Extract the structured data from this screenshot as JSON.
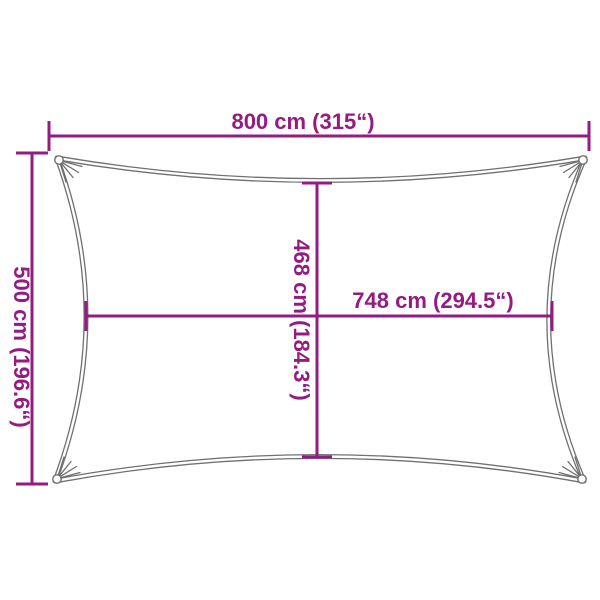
{
  "diagram": {
    "type": "shade-sail-dimension-diagram",
    "colors": {
      "dimension": "#941b80",
      "sail": "#707070",
      "gap": "#ffffff"
    },
    "labels": {
      "width": "800 cm (315“)",
      "height": "500 cm (196.6“)",
      "inner_width": "748 cm (294.5“)",
      "inner_height": "468 cm (184.3“)"
    }
  }
}
